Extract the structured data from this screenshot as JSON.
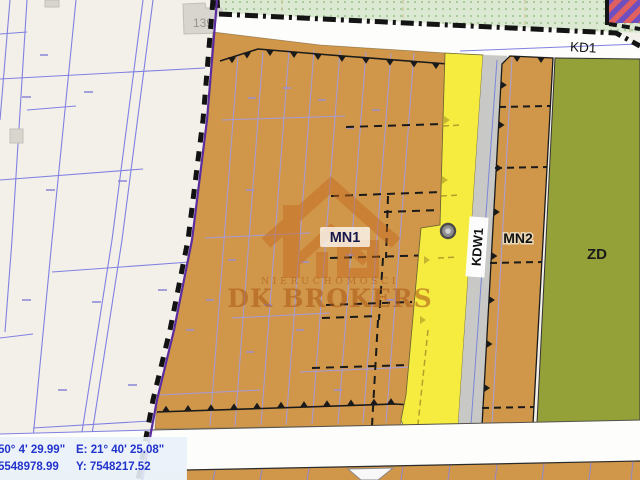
{
  "window": {
    "width": 640,
    "height": 480,
    "app": "zoning-plan-map-viewer"
  },
  "map": {
    "zones": [
      {
        "id": "MN1",
        "label": "MN1",
        "color": "#d0974a"
      },
      {
        "id": "MN2",
        "label": "MN2",
        "color": "#d0974a"
      },
      {
        "id": "ZD",
        "label": "ZD",
        "color": "#94a138"
      }
    ],
    "roads": [
      {
        "id": "KD1",
        "label": "KD1",
        "color": "#ffffff"
      },
      {
        "id": "KDW1",
        "label": "KDW1",
        "color": "#c8c8c6"
      }
    ],
    "parcel_label": "139",
    "colors": {
      "background": "#f3f0ea",
      "zone_orange": "#d0974a",
      "road_yellow": "#f5ec3f",
      "road_gray": "#c8c8c6",
      "zone_green": "#94a138",
      "greenery_strip": "#dbe9d3",
      "boundary_purple": "#5a2ca0",
      "cadastral_blue": "#8080e2",
      "stripe_red": "#e05f5f",
      "stripe_purple": "#6f4fc0"
    }
  },
  "watermark": {
    "subtitle": "NIERUCHOMOŚCI",
    "title": "DK BROKERS"
  },
  "statusbar": {
    "latitude": "50° 4' 29.99\"",
    "longitude": "E: 21° 40' 25.08\"",
    "northing": "5548978.99",
    "easting": "Y: 7548217.52",
    "text_color": "#2233cc"
  }
}
